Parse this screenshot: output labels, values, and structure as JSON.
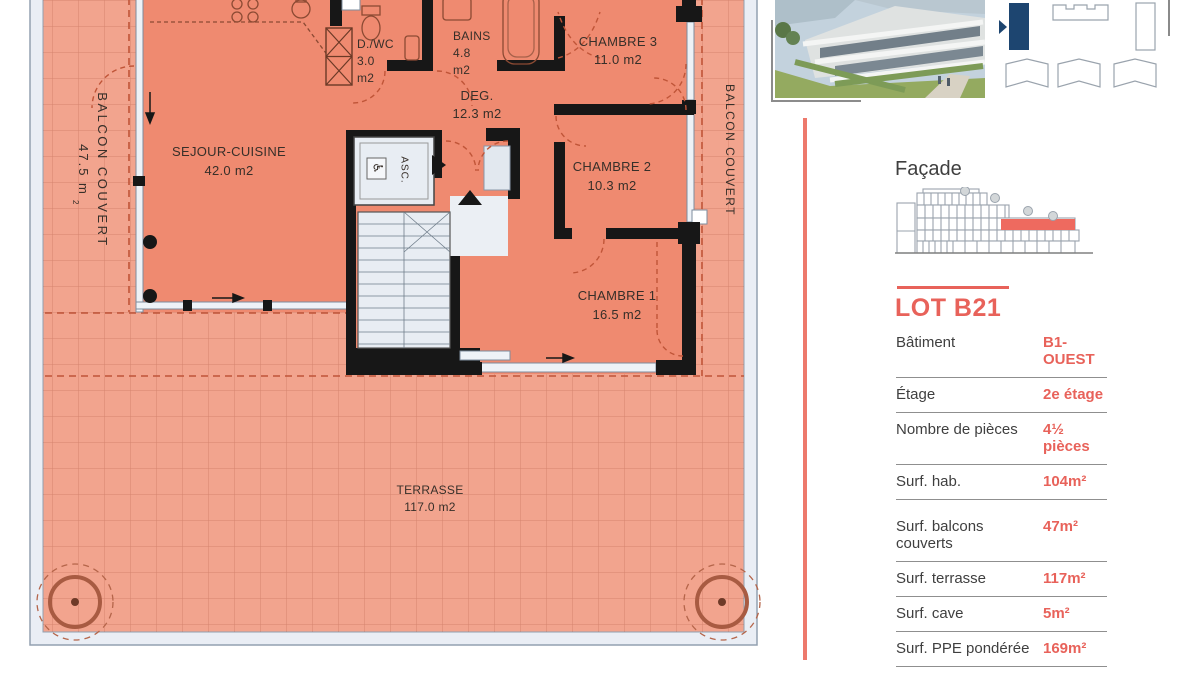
{
  "plan": {
    "rooms": {
      "sejour": {
        "name": "SEJOUR-CUISINE",
        "area": "42.0 m2"
      },
      "dwc": {
        "name": "D./WC",
        "area_num": "3.0",
        "area_unit": "m2"
      },
      "bains": {
        "name": "BAINS",
        "area_num": "4.8",
        "area_unit": "m2"
      },
      "deg": {
        "name": "DEG.",
        "area": "12.3 m2"
      },
      "chambre3": {
        "name": "CHAMBRE 3",
        "area": "11.0 m2"
      },
      "chambre2": {
        "name": "CHAMBRE 2",
        "area": "10.3 m2"
      },
      "chambre1": {
        "name": "CHAMBRE 1",
        "area": "16.5 m2"
      },
      "terrasse": {
        "name": "TERRASSE",
        "area": "117.0 m2"
      }
    },
    "balcony_left": {
      "label": "BALCON COUVERT",
      "area": "47.5 m",
      "area_sup": "2"
    },
    "balcony_right": {
      "label": "BALCON COUVERT"
    },
    "elevator": {
      "label": "ASC.",
      "wheelchair_icon": "♿"
    }
  },
  "sidebar": {
    "facade": {
      "title": "Façade"
    },
    "lot": {
      "title": "LOT B21",
      "rows": [
        {
          "label": "Bâtiment",
          "value": "B1-OUEST"
        },
        {
          "label": "Étage",
          "value": "2e étage"
        },
        {
          "label": "Nombre de pièces",
          "value": "4½ pièces"
        },
        {
          "label": "Surf. hab.",
          "value": "104m²"
        },
        {
          "label": "Surf. balcons couverts",
          "value": "47m²"
        },
        {
          "label": "Surf. terrasse",
          "value": "117m²"
        },
        {
          "label": "Surf. cave",
          "value": "5m²"
        },
        {
          "label": "Surf. PPE pondérée",
          "value": "169m²"
        }
      ]
    }
  },
  "colors": {
    "accent": "#e8625a",
    "site_plan_building": "#1d4570",
    "interior": "#ef8a70",
    "balcony": "#f2a48e",
    "wall": "#171717"
  }
}
